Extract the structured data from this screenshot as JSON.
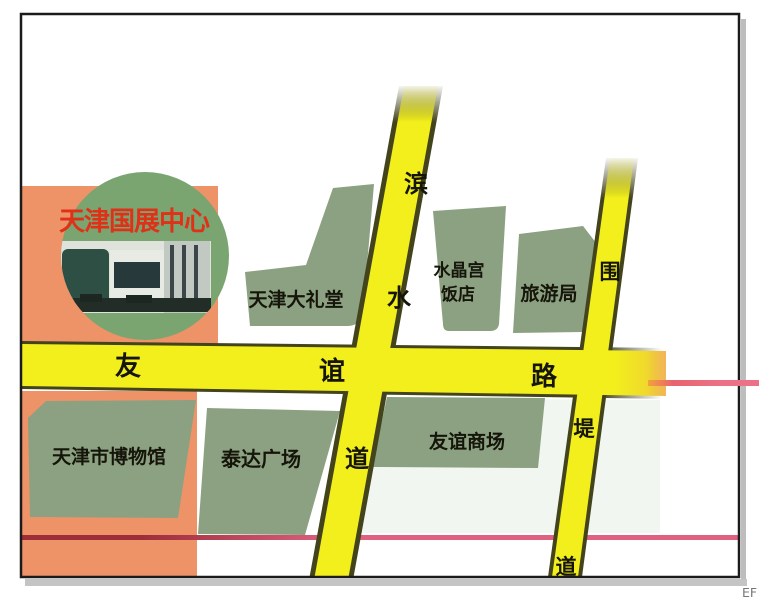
{
  "inset": {
    "title": "天津国展中心",
    "photo": "exhibition-center-building-photo"
  },
  "roads": {
    "youyi_lu": {
      "name": "友谊路",
      "chars": [
        "友",
        "谊",
        "路"
      ]
    },
    "binshui_dao": {
      "name": "滨水道",
      "chars": [
        "滨",
        "水",
        "道"
      ]
    },
    "weidi_dao": {
      "name": "围堤道",
      "chars": [
        "围",
        "堤",
        "道"
      ]
    }
  },
  "places": {
    "grand_hall": "天津大礼堂",
    "crystal_palace_line1": "水晶宫",
    "crystal_palace_line2": "饭店",
    "tourism_bureau": "旅游局",
    "museum": "天津市博物馆",
    "teda_plaza": "泰达广场",
    "friendship_mall": "友谊商场"
  },
  "corner_text": "EF",
  "colors": {
    "road_yellow": "#f2ef1c",
    "road_edge": "#43431c",
    "block_green": "#8ba181",
    "circle_green": "#7aa571",
    "orange_zone": "#ee9268",
    "title_red": "#e03018",
    "line_pink": "#e0617f",
    "line_dark_red": "#9c2e3a"
  }
}
